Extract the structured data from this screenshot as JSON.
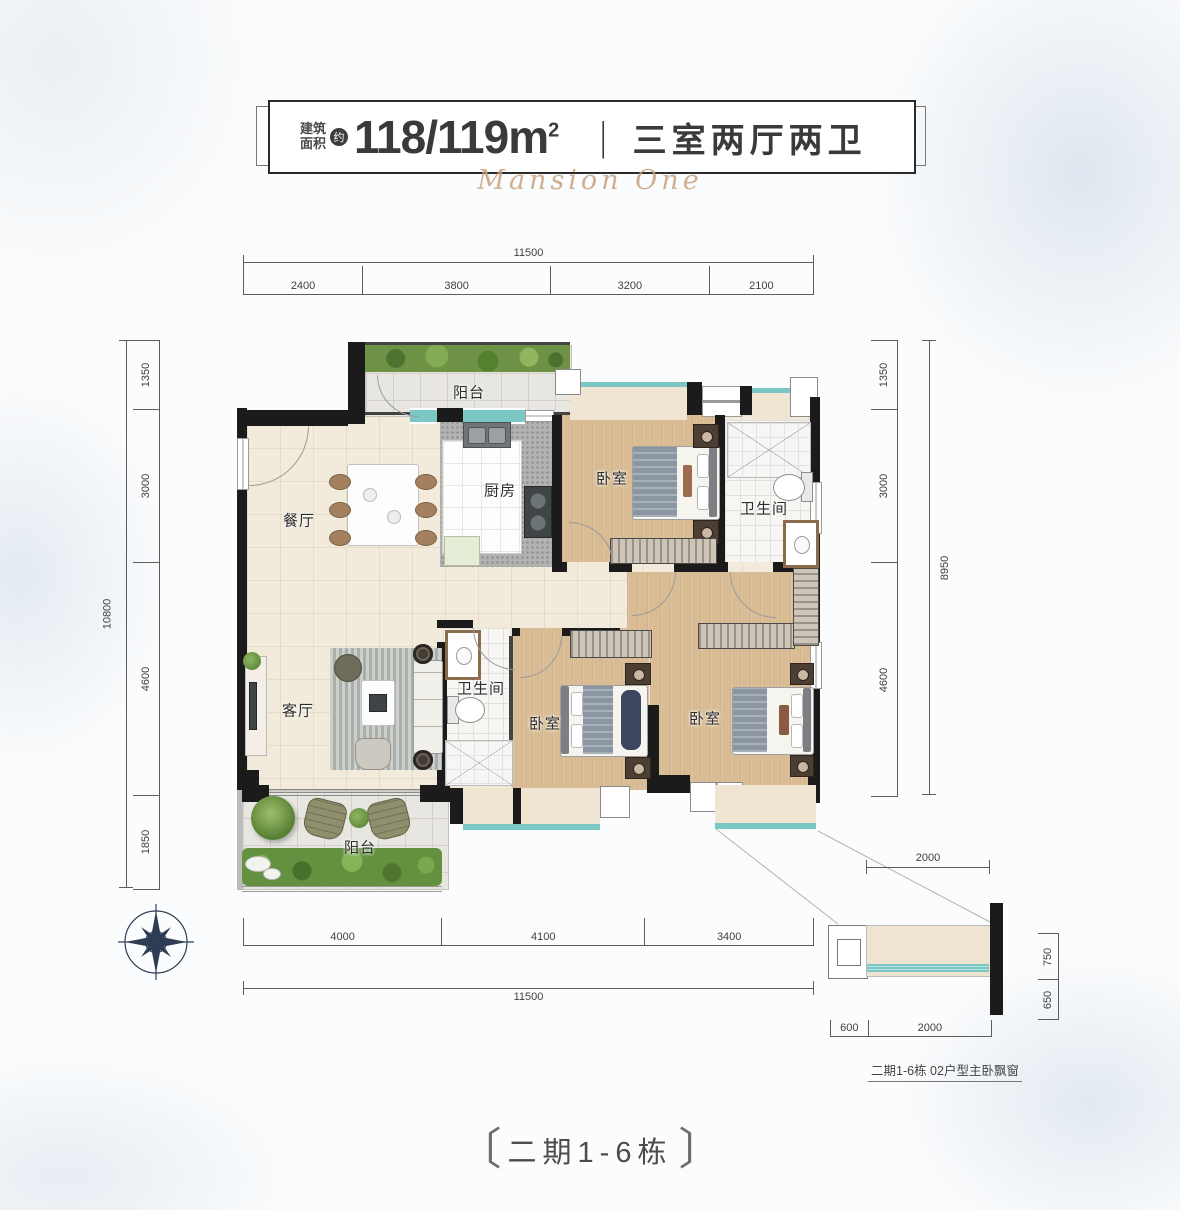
{
  "header": {
    "area_label_1": "建筑",
    "area_label_2": "面积",
    "approx": "约",
    "area_value": "118/119m",
    "area_exp": "2",
    "divider": "|",
    "layout": "三室两厅两卫",
    "watermark": "Mansion One"
  },
  "rooms": {
    "balcony_top": "阳台",
    "kitchen": "厨房",
    "dining": "餐厅",
    "bedroom_top": "卧室",
    "bath_top": "卫生间",
    "living": "客厅",
    "bath_mid": "卫生间",
    "bedroom_mid": "卧室",
    "bedroom_master": "卧室",
    "balcony_bottom": "阳台"
  },
  "dims": {
    "top": {
      "total": "11500",
      "segments": [
        "2400",
        "3800",
        "3200",
        "2100"
      ]
    },
    "left": {
      "total": "10800",
      "segments": [
        "1350",
        "3000",
        "4600",
        "1850"
      ]
    },
    "right": {
      "total": "8950",
      "segments": [
        "1350",
        "3000",
        "4600"
      ]
    },
    "bottom": {
      "total": "11500",
      "segments": [
        "4000",
        "4100",
        "3400"
      ]
    },
    "detail": {
      "top": "2000",
      "right": [
        "750",
        "650"
      ],
      "bottom": [
        "600",
        "2000"
      ]
    }
  },
  "detail_caption": "二期1-6栋 02户型主卧飘窗",
  "footer": {
    "bracket_left": "〔",
    "text": "二期1-6栋",
    "bracket_right": "〕"
  },
  "colors": {
    "wall": "#1b1b1b",
    "window_teal": "#7ac7c4",
    "wood_floor": "#d9bc93",
    "accent_gold": "#c9a27e",
    "compass_navy": "#2e3d55"
  }
}
